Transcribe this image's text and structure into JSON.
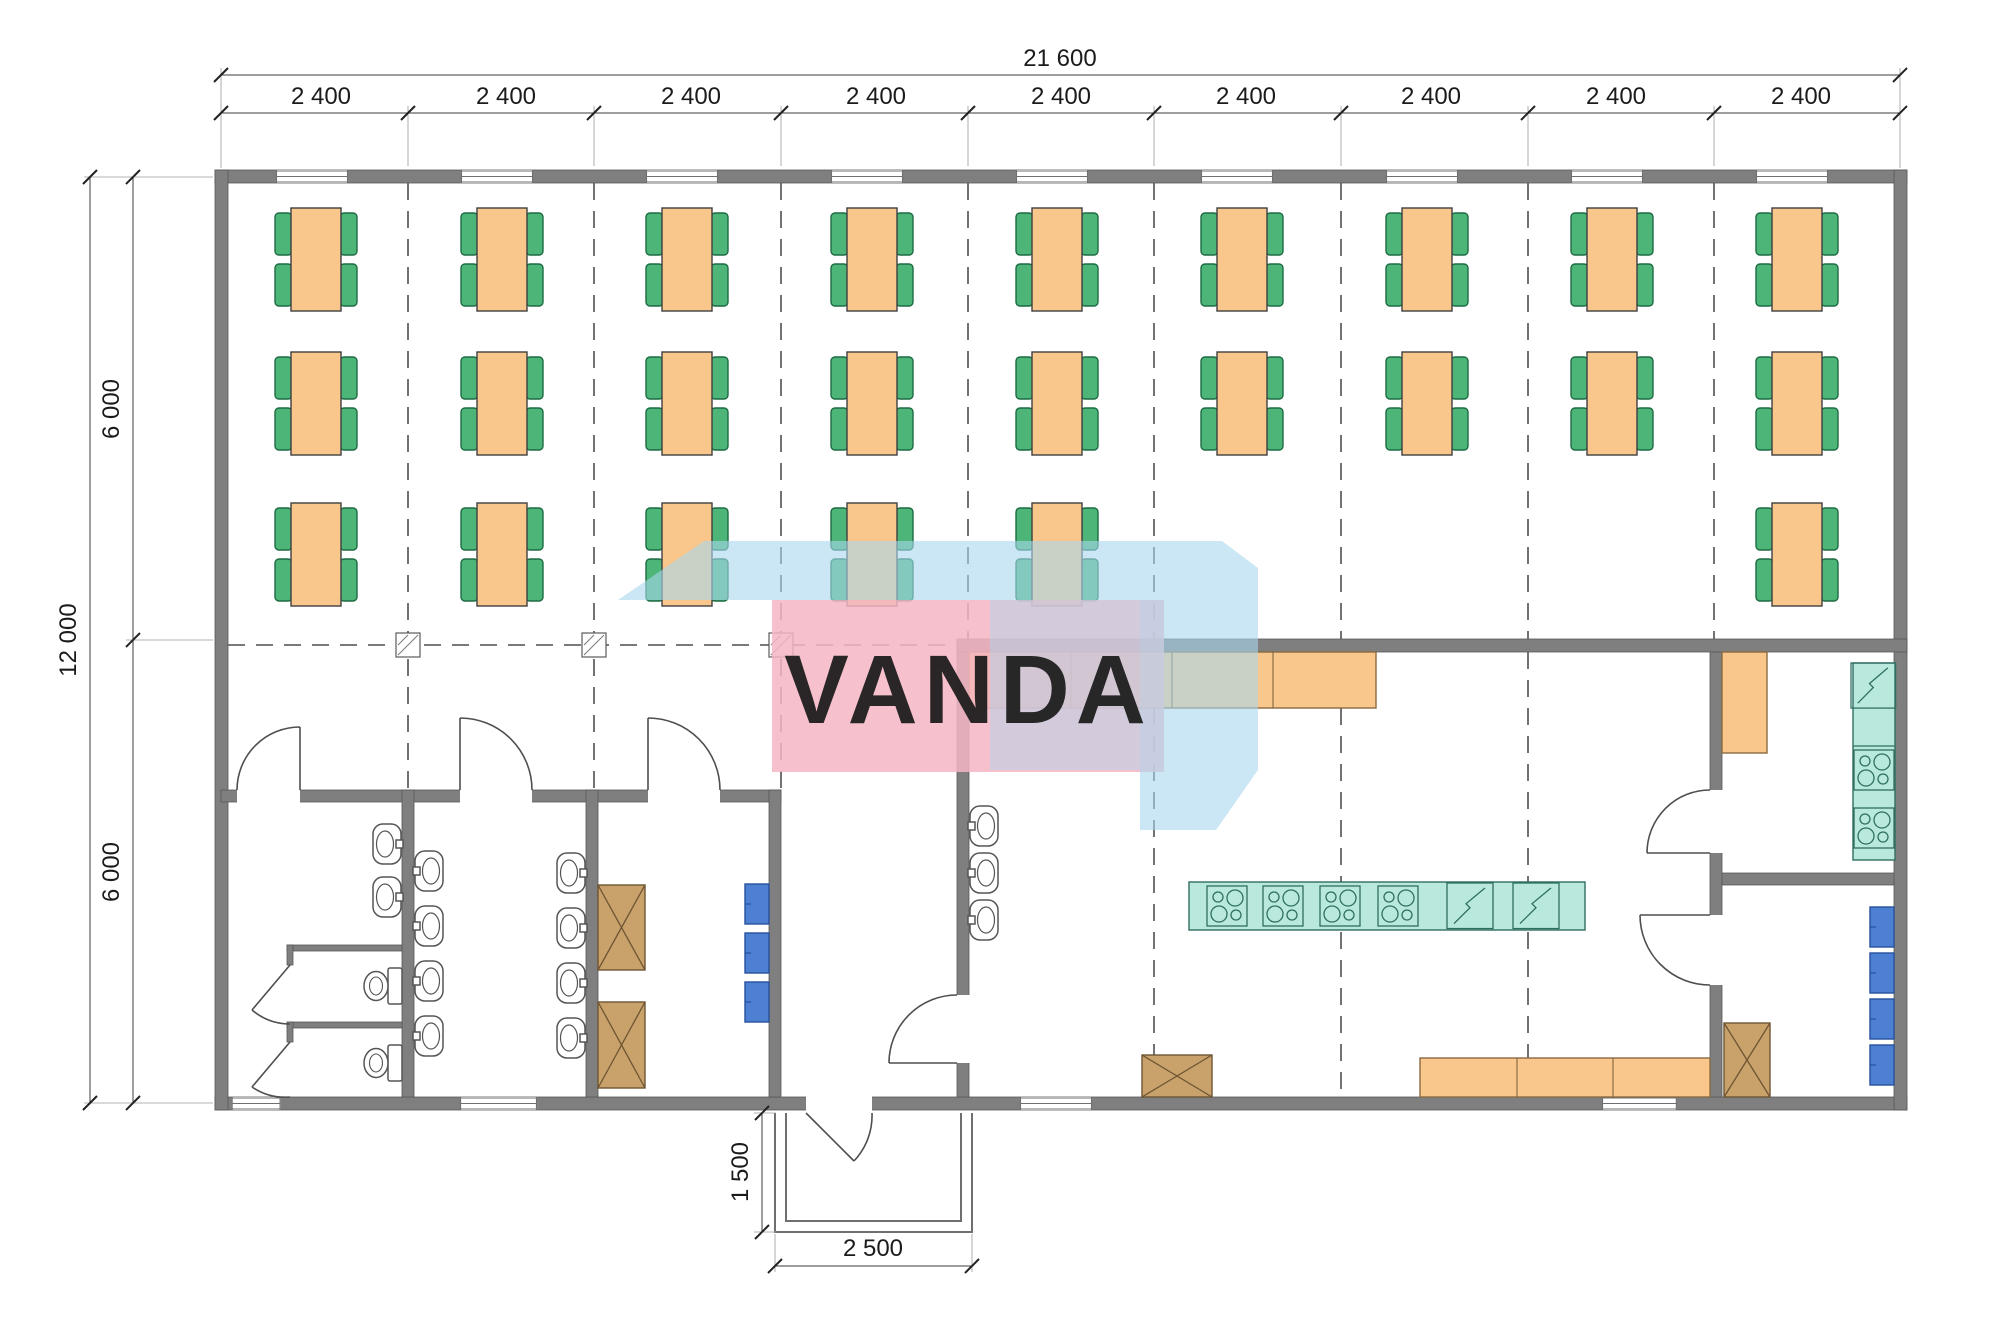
{
  "watermark": {
    "text": "VANDA",
    "pink": "#f5b6c3",
    "blue": "#a9d7ef",
    "text_color": "#ffffff"
  },
  "dimensions": {
    "top_total": "21 600",
    "top_bays": [
      "2 400",
      "2 400",
      "2 400",
      "2 400",
      "2 400",
      "2 400",
      "2 400",
      "2 400",
      "2 400"
    ],
    "left_total": "12 000",
    "left_upper": "6 000",
    "left_lower": "6 000",
    "porch_depth": "1 500",
    "porch_width": "2 500"
  },
  "plan": {
    "type": "floor_plan",
    "building": {
      "width_mm": 21600,
      "depth_mm": 12000,
      "bays": 9,
      "bay_width_mm": 2400,
      "half_depth_mm": 6000
    },
    "porch": {
      "depth_mm": 1500,
      "width_mm": 2500
    },
    "rooms": [
      "dining-hall",
      "sanitary-room",
      "washroom",
      "storage-room",
      "entrance-hall",
      "kitchen",
      "kitchen-room-upper",
      "kitchen-room-lower",
      "porch"
    ],
    "furniture_counts": {
      "dining_tables_4_seats": 24,
      "chairs": 96,
      "wash_basins": 13,
      "toilets": 2,
      "cooktop_units": 6,
      "diagonal_sink_units": 3,
      "blue_lockers": 7,
      "crossed_cabinets": 4,
      "orange_counter_segments": 8
    },
    "colors": {
      "wall": "#7f7f7f",
      "table": "#f9c78c",
      "chair": "#4cb577",
      "equipment_teal": "#b9e9dd",
      "locker_blue": "#4d80d3",
      "cabinet_brown": "#c9a26b"
    }
  }
}
